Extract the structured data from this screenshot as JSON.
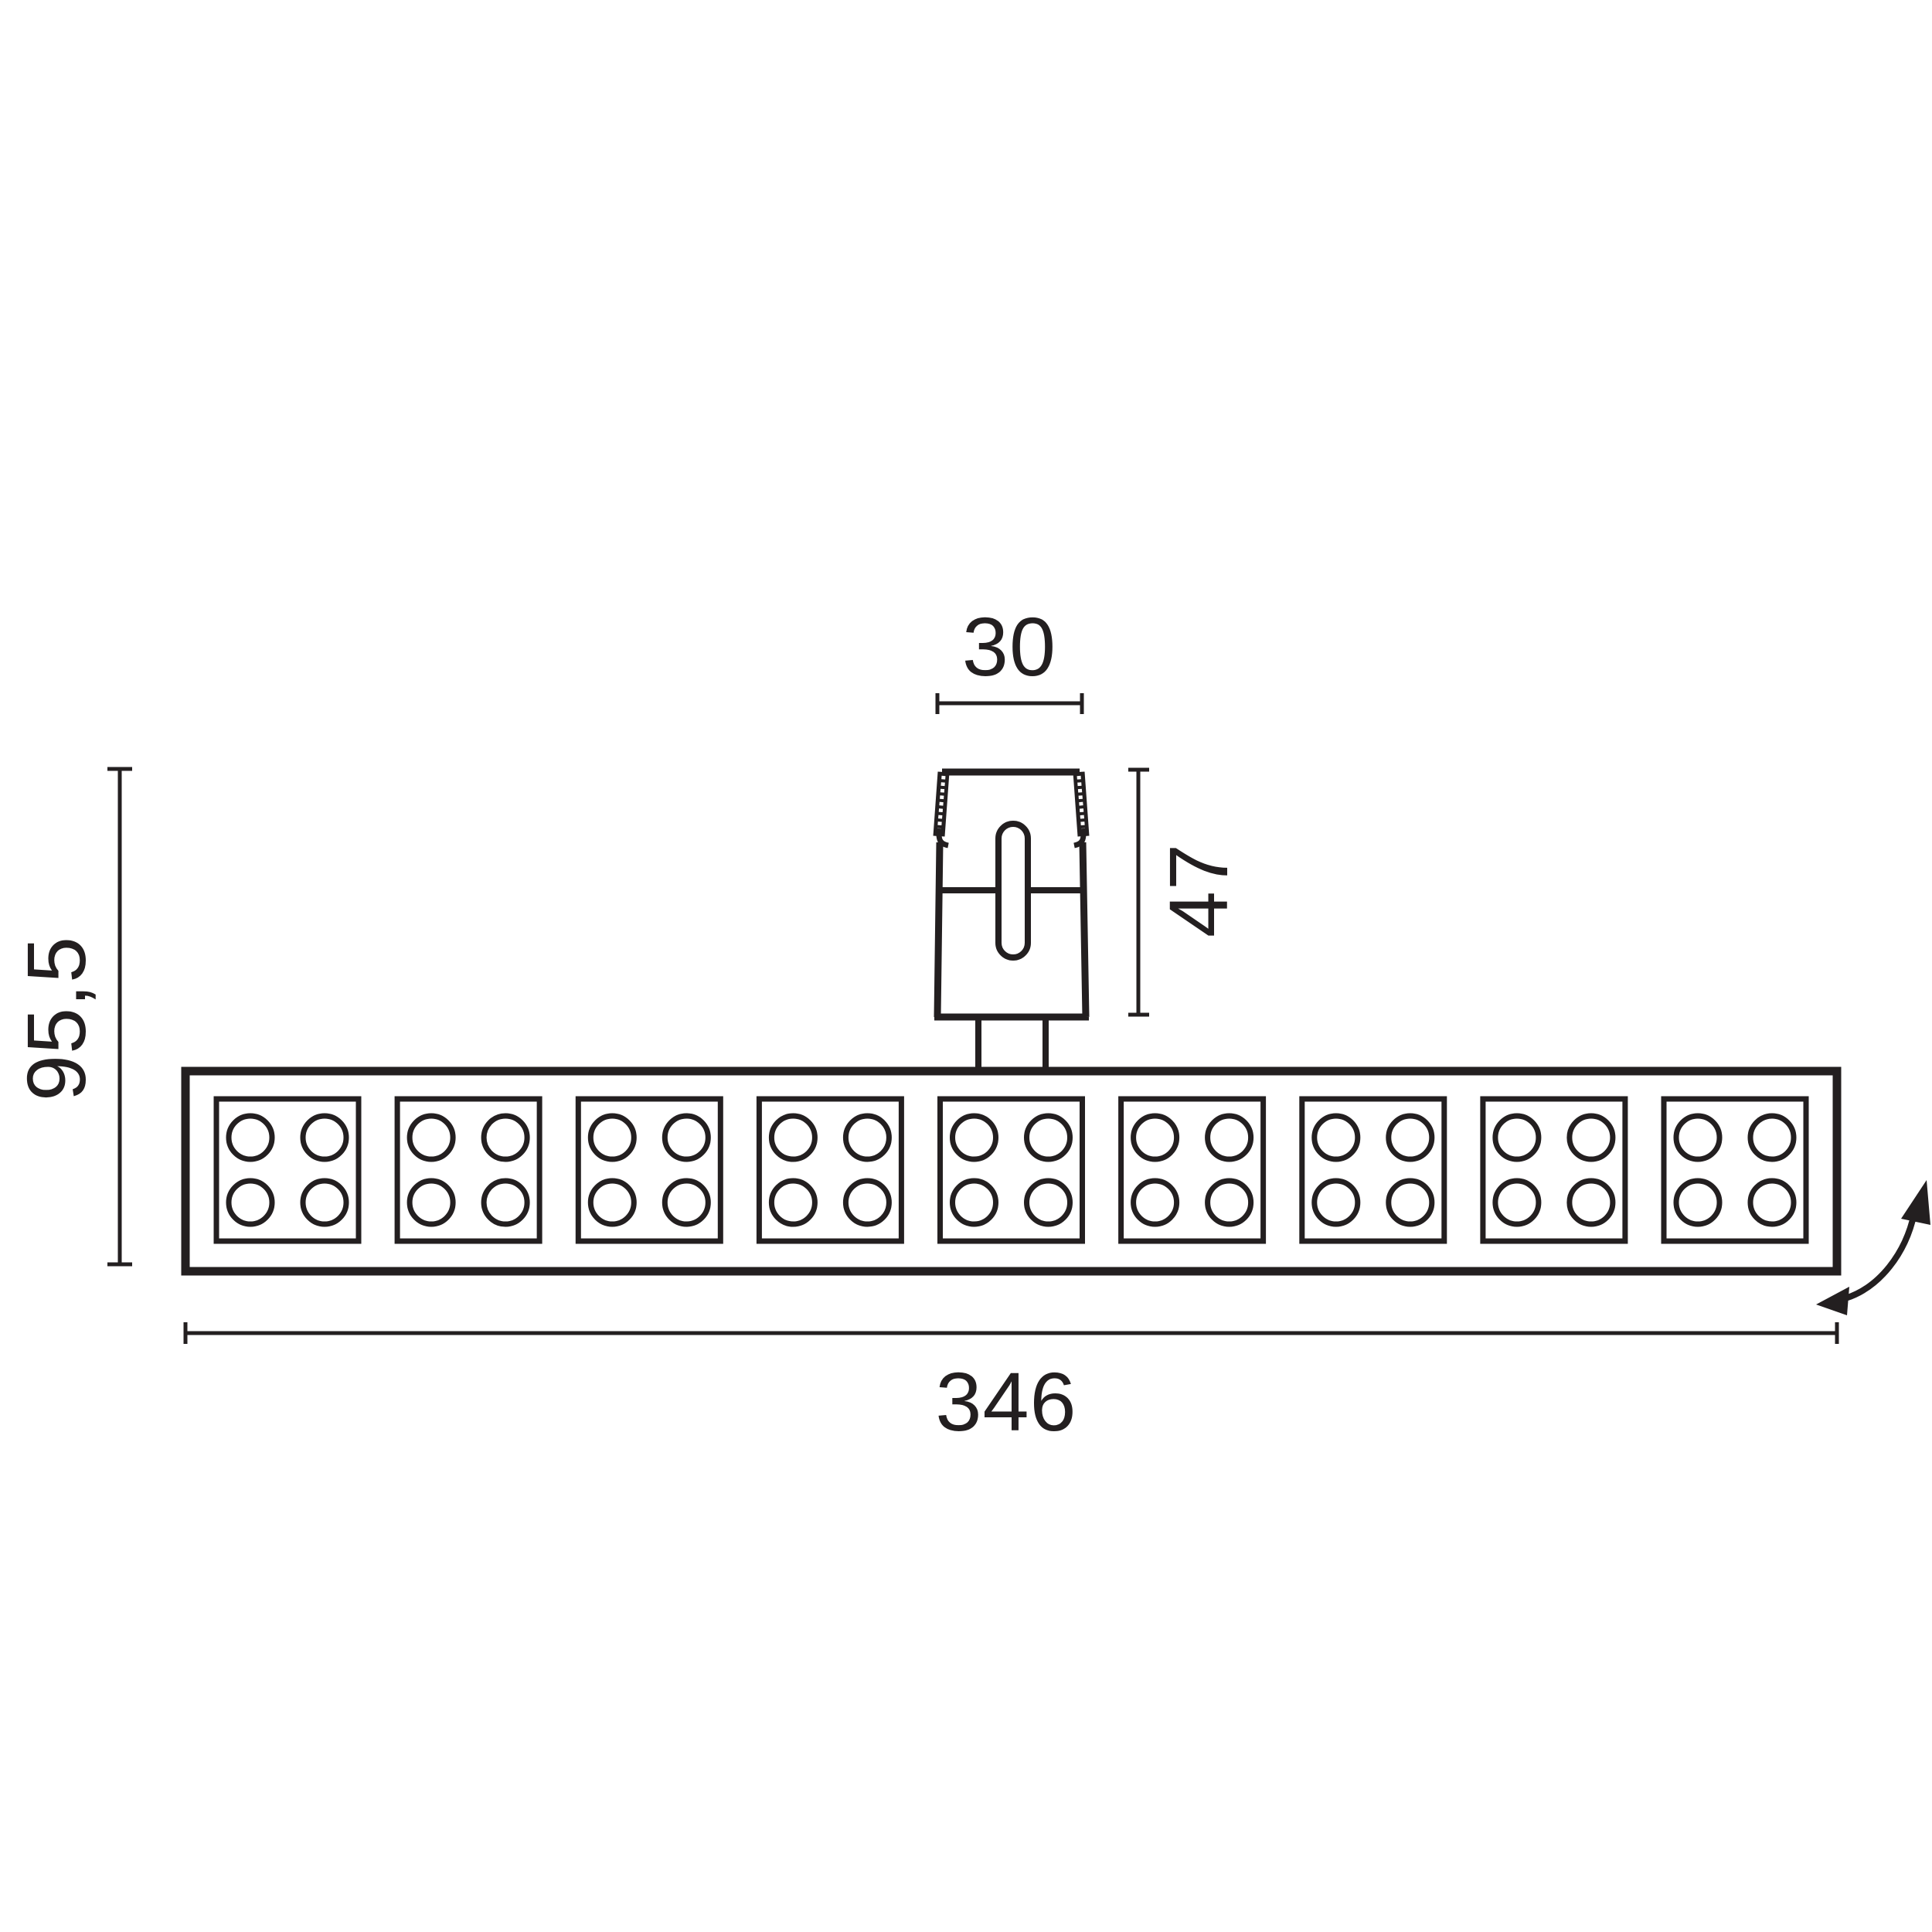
{
  "colors": {
    "line": "#231f20",
    "background": "#ffffff"
  },
  "dimensions": {
    "adapter_width_label": "30",
    "adapter_height_label": "47",
    "total_height_label": "95,5",
    "total_width_label": "346"
  },
  "luminaire": {
    "module_count": 9,
    "leds_per_module": 4
  }
}
